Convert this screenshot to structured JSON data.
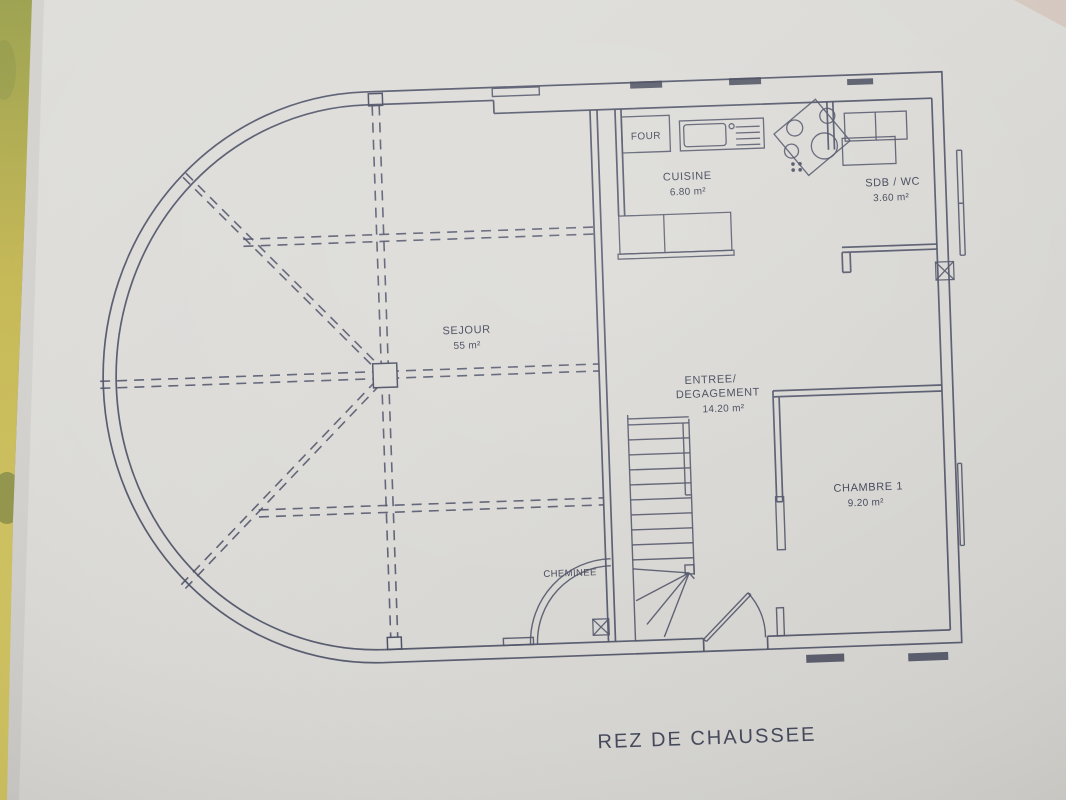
{
  "title": {
    "text": "REZ DE CHAUSSEE"
  },
  "rooms": {
    "sejour": {
      "name": "SEJOUR",
      "area": "55 m²"
    },
    "cuisine": {
      "name": "CUISINE",
      "area": "6.80 m²"
    },
    "sdb_wc": {
      "name": "SDB / WC",
      "area": "3.60 m²"
    },
    "entree": {
      "line1": "ENTREE/",
      "line2": "DEGAGEMENT",
      "area": "14.20 m²"
    },
    "chambre1": {
      "name": "CHAMBRE 1",
      "area": "9.20 m²"
    }
  },
  "fixtures": {
    "four": {
      "label": "FOUR"
    },
    "cheminee": {
      "label": "CHEMINEE"
    }
  },
  "colors": {
    "ink": "#3c4053",
    "paper": "#d9d8d4",
    "table_edge": "#b8ad4a"
  }
}
